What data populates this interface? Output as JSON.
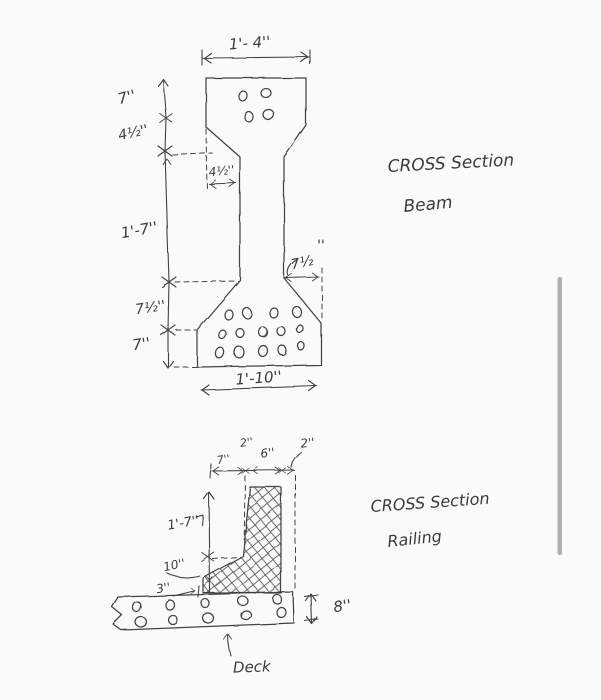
{
  "canvas": {
    "background": "#fafaf9",
    "ink_color": "#44423e",
    "scrollbar_color": "#aeaeae"
  },
  "beam": {
    "title_line1": "CROSS Section",
    "title_line2": "Beam",
    "dim_top_width": "1'- 4''",
    "dim_left_top_flange": "7''",
    "dim_left_taper": "4½''",
    "dim_left_web": "1'-7''",
    "dim_left_bottom_taper": "7½''",
    "dim_left_bottom_flange": "7''",
    "dim_web_width": "4½''",
    "dim_right_taper": "7½",
    "dim_right_taper_marks": "''",
    "dim_bottom_width": "1'-10''"
  },
  "railing": {
    "title_line1": "CROSS Section",
    "title_line2": "Railing",
    "dim_top_1": "7''",
    "dim_top_2": "2''",
    "dim_top_3": "6''",
    "dim_top_4": "2''",
    "dim_left_1": "1'-7''",
    "dim_left_2": "10''",
    "dim_left_3": "3''",
    "dim_deck_thickness": "8''",
    "deck_label": "Deck"
  }
}
